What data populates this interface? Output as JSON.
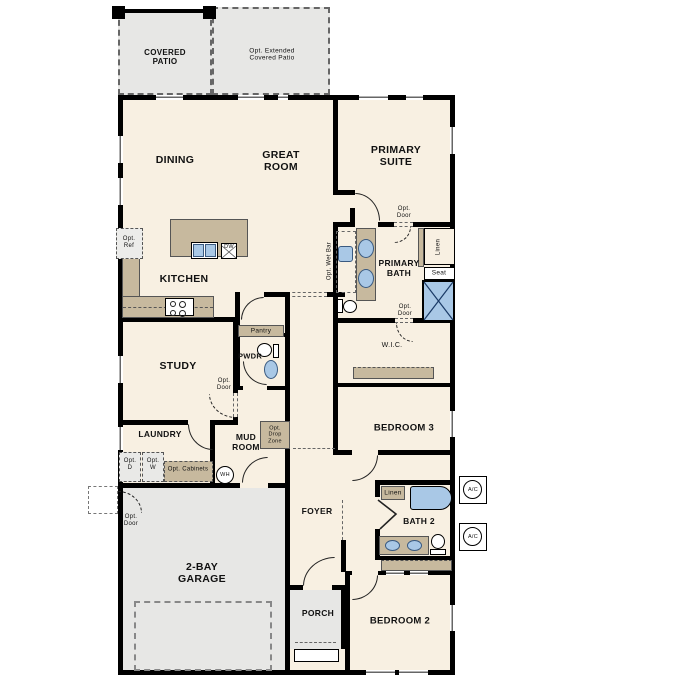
{
  "rooms": {
    "covered_patio": "COVERED\nPATIO",
    "ext_patio": "Opt. Extended\nCovered Patio",
    "dining": "DINING",
    "great_room": "GREAT\nROOM",
    "primary_suite": "PRIMARY\nSUITE",
    "kitchen": "KITCHEN",
    "primary_bath": "PRIMARY\nBATH",
    "pantry": "Pantry",
    "pwdr": "PWDR",
    "study": "STUDY",
    "laundry": "LAUNDRY",
    "mud_room": "MUD\nROOM",
    "wic": "W.I.C.",
    "bedroom3": "BEDROOM 3",
    "foyer": "FOYER",
    "bath2": "BATH 2",
    "garage": "2-BAY\nGARAGE",
    "porch": "PORCH",
    "bedroom2": "BEDROOM 2"
  },
  "annotations": {
    "opt_ref": "Opt.\nRef",
    "opt_door": "Opt.\nDoor",
    "opt_wet_bar": "Opt. Wet Bar",
    "linen": "Linen",
    "seat": "Seat",
    "opt_drop_zone": "Opt.\nDrop\nZone",
    "opt_d": "Opt.\nD",
    "opt_w": "Opt.\nW",
    "opt_cabinets": "Opt. Cabinets",
    "wh": "WH",
    "dw": "DW",
    "ac": "A/C"
  },
  "colors": {
    "floor": "#f8f0e2",
    "wall": "#000000",
    "cabinetry": "#c7b99e",
    "exterior_concrete": "#e7e7e5",
    "fixture_blue": "#a9c8e6"
  }
}
